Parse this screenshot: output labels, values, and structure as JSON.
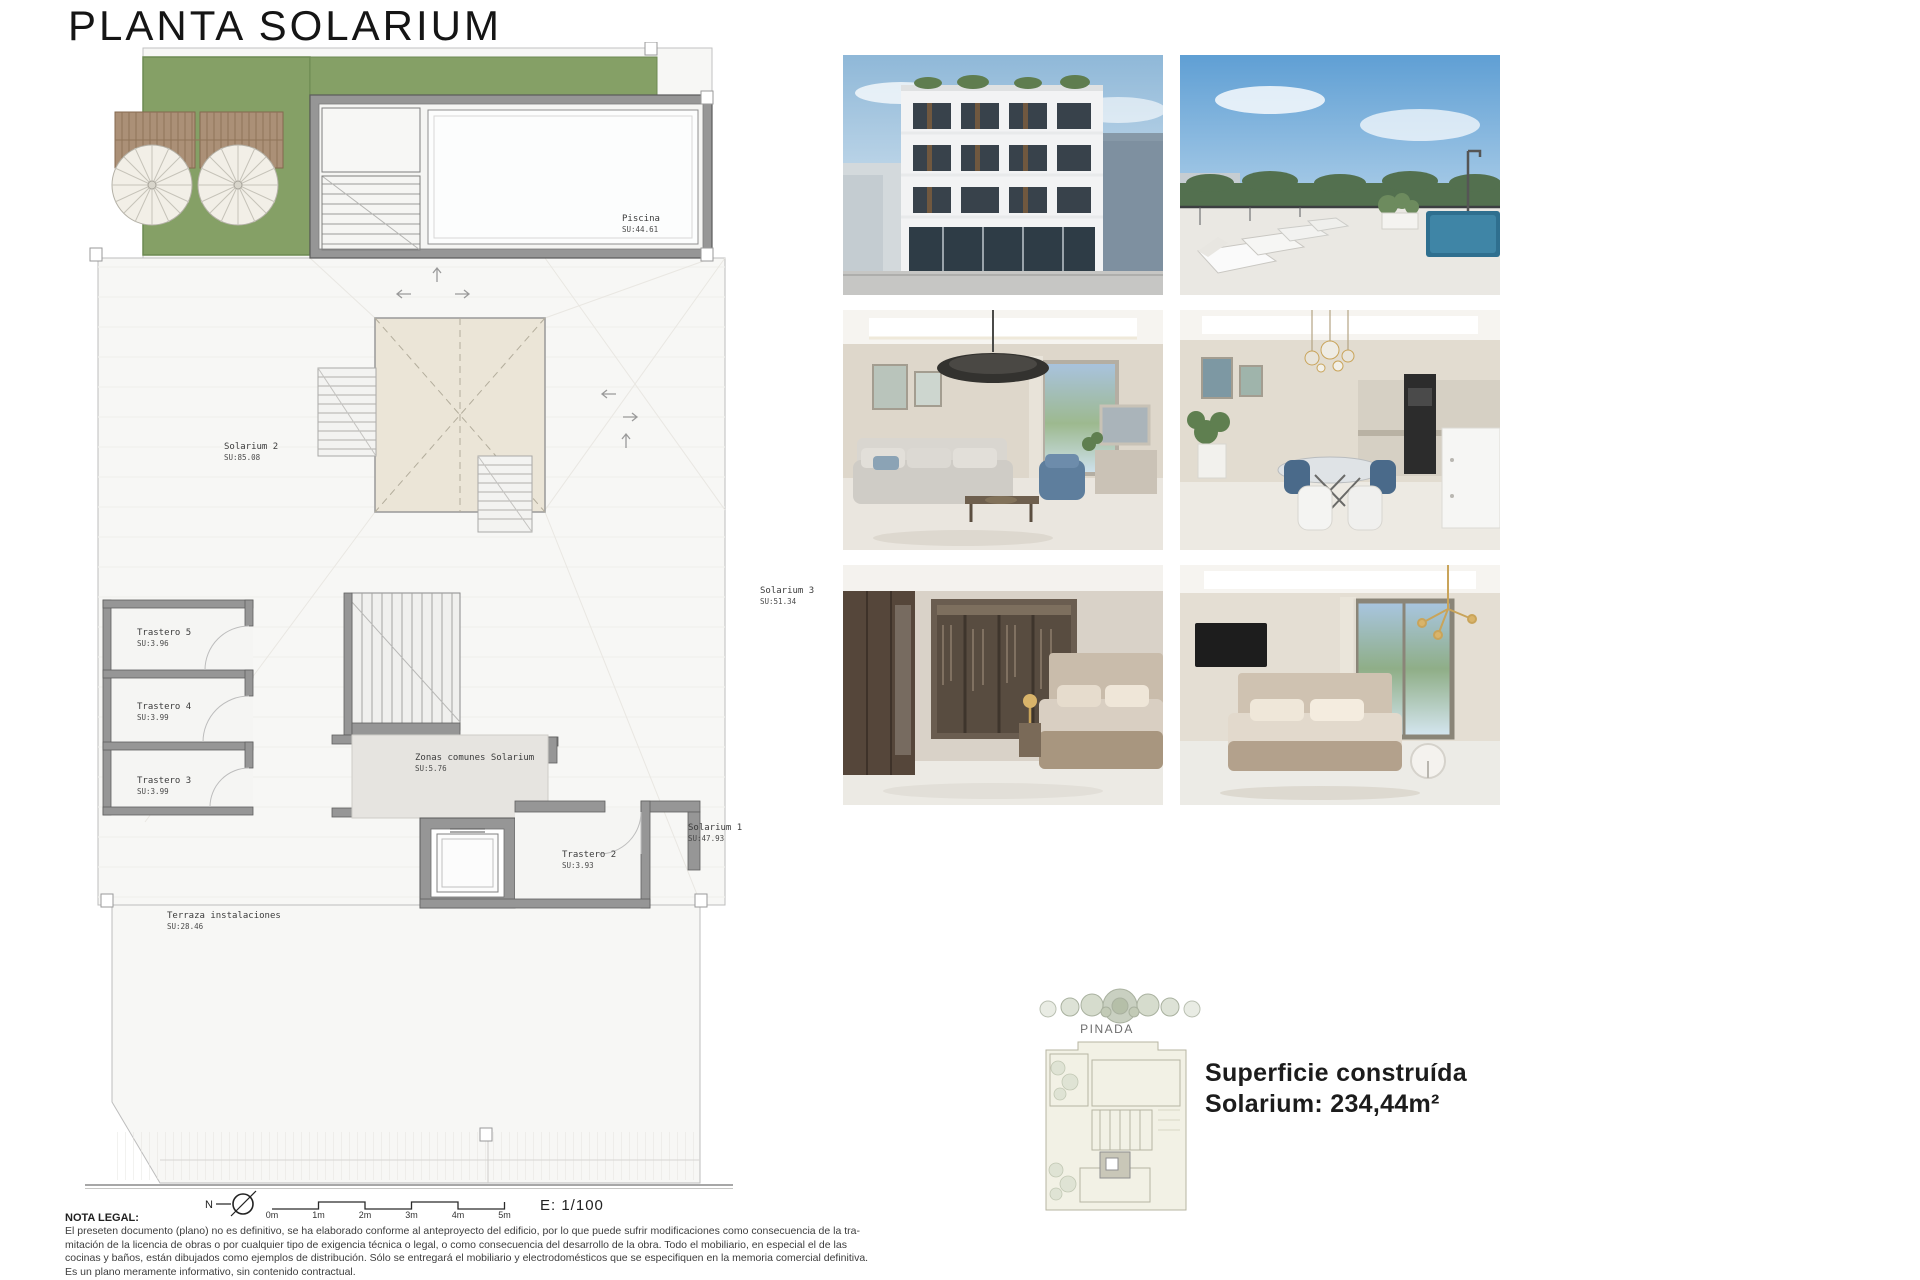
{
  "title": "PLANTA SOLARIUM",
  "plan": {
    "rooms": [
      {
        "name": "Piscina",
        "su": "SU:44.61"
      },
      {
        "name": "Solarium 2",
        "su": "SU:85.08"
      },
      {
        "name": "Solarium 3",
        "su": "SU:51.34"
      },
      {
        "name": "Trastero 5",
        "su": "SU:3.96"
      },
      {
        "name": "Trastero 4",
        "su": "SU:3.99"
      },
      {
        "name": "Trastero 3",
        "su": "SU:3.99"
      },
      {
        "name": "Zonas comunes Solarium",
        "su": "SU:5.76"
      },
      {
        "name": "Trastero 2",
        "su": "SU:3.93"
      },
      {
        "name": "Solarium 1",
        "su": "SU:47.93"
      },
      {
        "name": "Terraza instalaciones",
        "su": "SU:28.46"
      }
    ],
    "north_label": "N",
    "scale_ticks": [
      "0m",
      "1m",
      "2m",
      "3m",
      "4m",
      "5m"
    ],
    "scale_ratio": "E: 1/100"
  },
  "gallery_photos": [
    "building-exterior",
    "rooftop-pool-terrace",
    "living-room",
    "dining-kitchen",
    "bedroom-dressing",
    "bedroom-window"
  ],
  "site": {
    "label": "PINADA"
  },
  "summary": {
    "line1": "Superficie construída",
    "line2": "Solarium: 234,44m²"
  },
  "legal": {
    "heading": "NOTA LEGAL:",
    "lines": [
      "El preseten documento (plano) no es definitivo, se ha elaborado conforme al anteproyecto del edificio, por lo que puede sufrir modificaciones como consecuencia de la tra-",
      "mitación de la licencia de obras o por cualquier tipo de exigencia técnica o legal, o como consecuencia del desarrollo de la obra. Todo el mobiliario, en especial el de las",
      "cocinas y baños, están dibujados como ejemplos de distribución. Sólo se entregará el mobiliario y electrodomésticos que se especifiquen en la memoria comercial definitiva.",
      "Es un plano meramente informativo, sin contenido contractual."
    ]
  },
  "colors": {
    "grass": "#85a066",
    "wall": "#969696",
    "skylight": "#ebe5d7",
    "pool_water": "#fcfdfd",
    "deck_wood": "#ab9077"
  }
}
